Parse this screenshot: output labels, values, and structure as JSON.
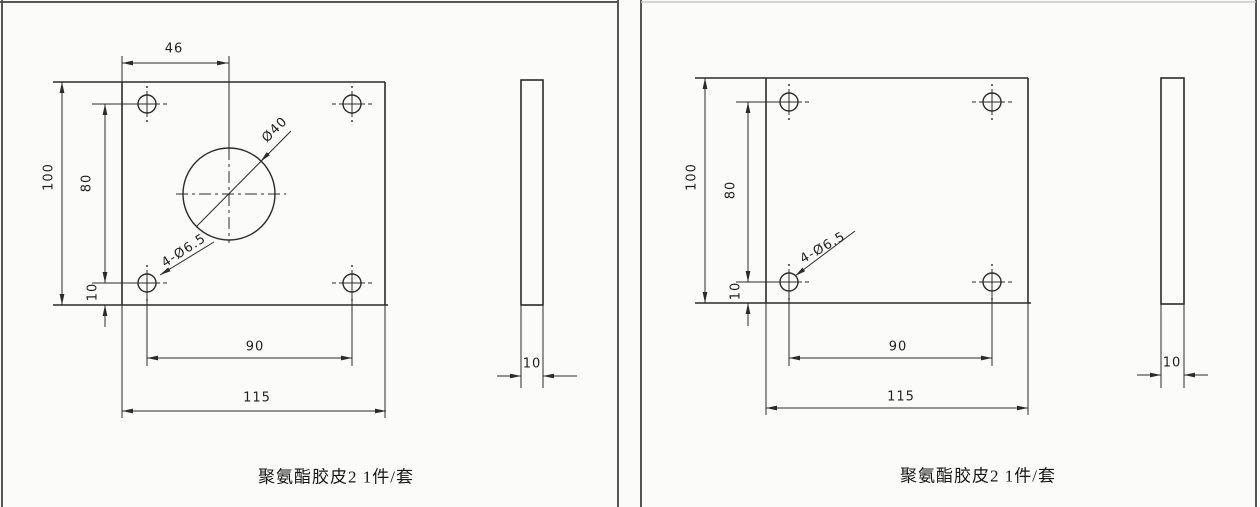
{
  "drawing": {
    "type": "engineering-drawing",
    "sheet_panels": 2
  },
  "panels": [
    {
      "caption": "聚氨酯胶皮2 1件/套",
      "front": {
        "width": "115",
        "height": "100",
        "hole_pitch_h": "90",
        "hole_pitch_v": "80",
        "bottom_offset": "10",
        "center_offset": "46",
        "center_hole": "Ø40",
        "corner_holes": "4-Ø6.5"
      },
      "side": {
        "thickness": "10"
      }
    },
    {
      "caption": "聚氨酯胶皮2 1件/套",
      "front": {
        "width": "115",
        "height": "100",
        "hole_pitch_h": "90",
        "hole_pitch_v": "80",
        "bottom_offset": "10",
        "corner_holes": "4-Ø6.5"
      },
      "side": {
        "thickness": "10"
      }
    }
  ],
  "colors": {
    "line": "#2b2b2b",
    "border": "#555555",
    "background": "#fbfbf9"
  }
}
